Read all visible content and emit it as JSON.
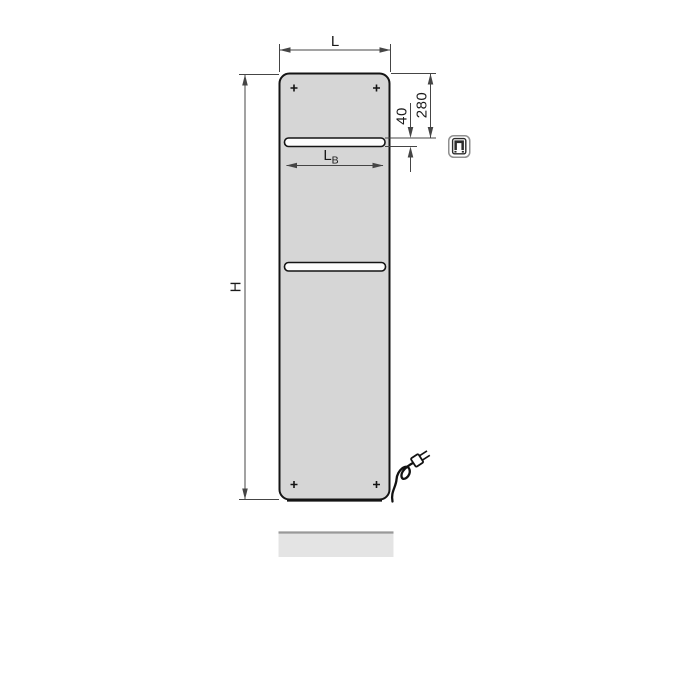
{
  "page": {
    "background": "#ffffff",
    "content": "technical-dimension-drawing-of-electric-panel-radiator"
  },
  "diagram": {
    "labels": {
      "overall_width": "L",
      "overall_height": "H",
      "rail_width_main": "L",
      "rail_width_sub": "B",
      "top_to_rail": "280",
      "rail_gap": "40"
    },
    "colors": {
      "panel_fill": "#d6d6d6",
      "panel_outline": "#141414",
      "dimension_line": "#454545",
      "rail_fill": "#fdfdfd",
      "reflection_fill": "#e4e4e4",
      "reflection_edge": "#999999",
      "cord": "#121212",
      "icon_border": "#8f8f8f",
      "icon_glyph": "#2b2b2b"
    },
    "icons": {
      "badge": "electric-plug-icon"
    }
  }
}
